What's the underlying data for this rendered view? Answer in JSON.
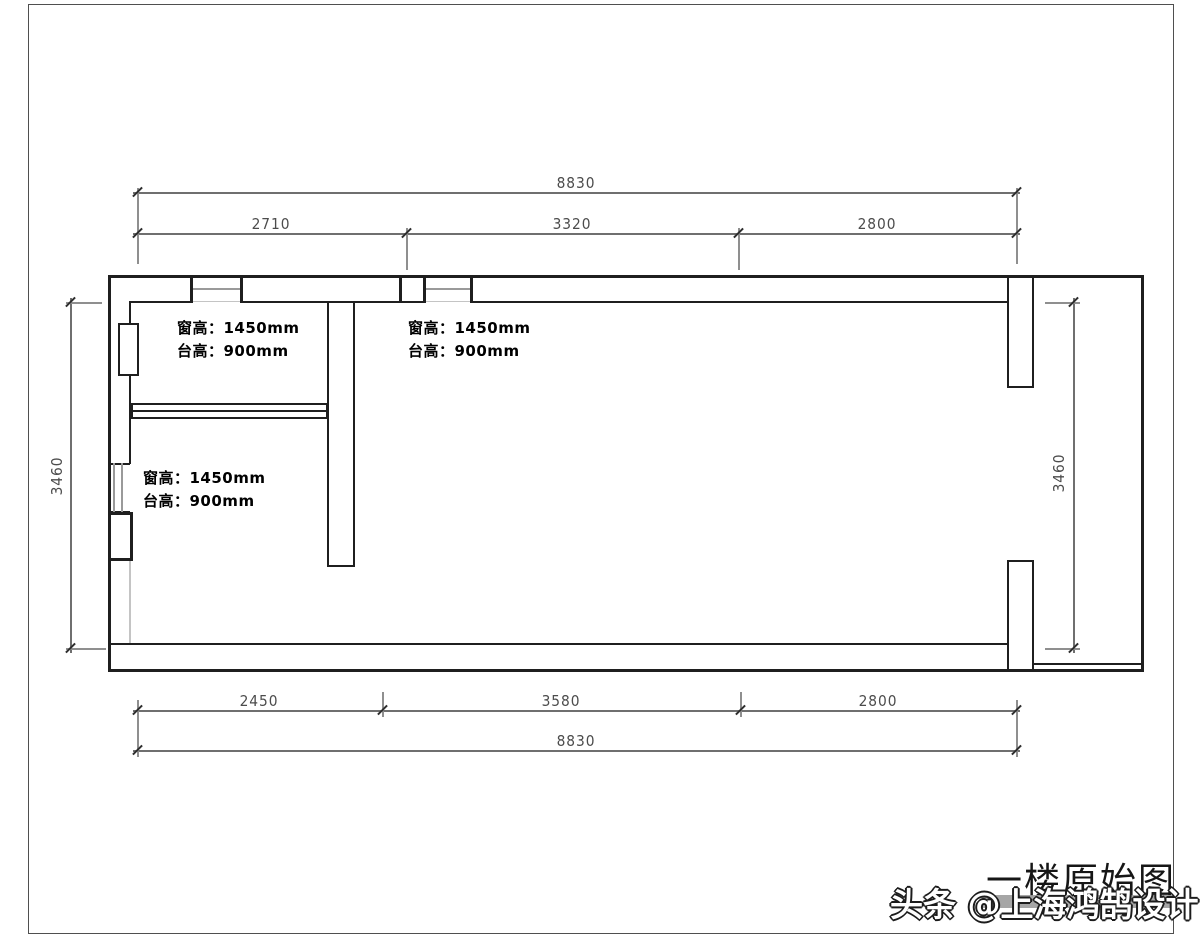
{
  "drawing": {
    "caption": "一楼原始图",
    "watermark": "头条 @上海鸿鹄设计",
    "dimensions": {
      "top": {
        "overall": "8830",
        "segments": [
          "2710",
          "3320",
          "2800"
        ]
      },
      "bottom": {
        "overall": "8830",
        "segments": [
          "2450",
          "3580",
          "2800"
        ]
      },
      "left": "3460",
      "right": "3460"
    },
    "annotations": [
      {
        "window_height": "窗高：1450mm",
        "sill_height": "台高：900mm"
      },
      {
        "window_height": "窗高：1450mm",
        "sill_height": "台高：900mm"
      },
      {
        "window_height": "窗高：1450mm",
        "sill_height": "台高：900mm"
      }
    ],
    "colors": {
      "wall": "#1f1f1f",
      "dim_line": "#6f6f6f",
      "dim_text": "#4c4c4c",
      "glass": "#9a9a9a",
      "frame": "#4f4f4f",
      "watermark_fill": "#ffffff",
      "watermark_outline": "#1c1c1c",
      "watermark_bar": "#9c9c9c"
    }
  }
}
